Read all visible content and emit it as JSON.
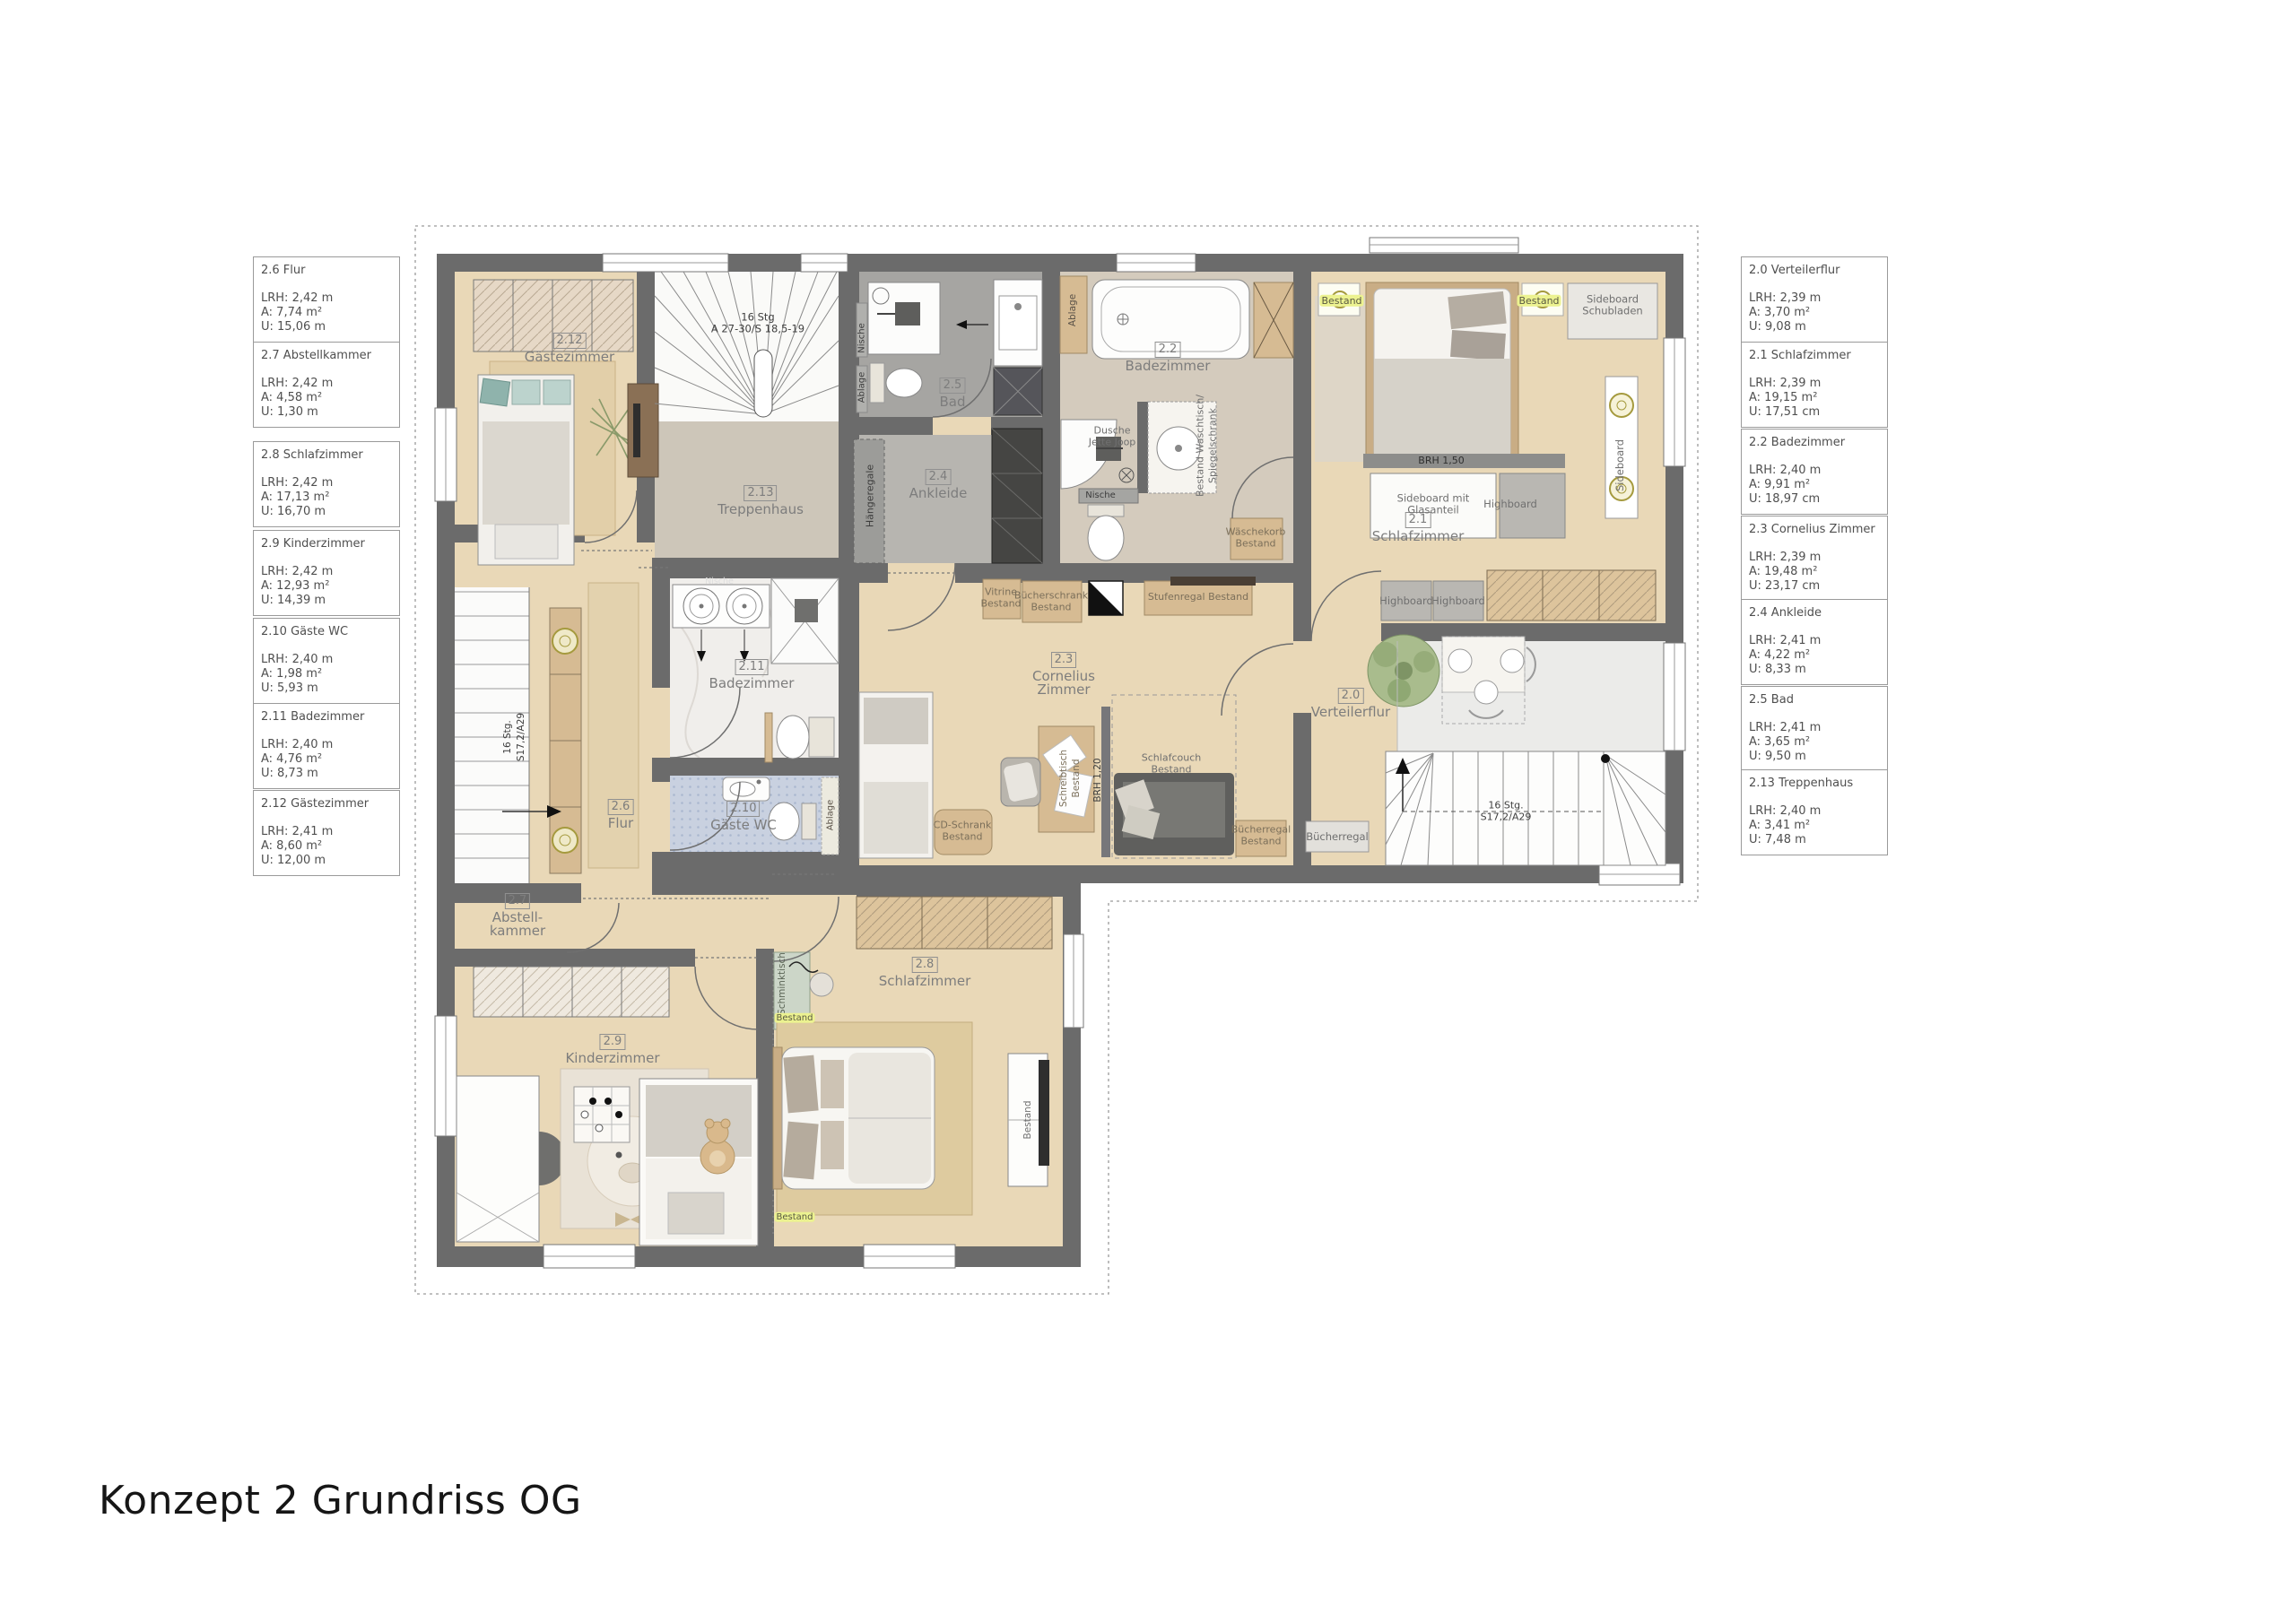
{
  "title": "Konzept 2 Grundriss OG",
  "colors": {
    "wall": "#6b6b6b",
    "wood_floor": "#e9d8b7",
    "greige_floor": "#d4cbbd",
    "stone_gray_floor": "#a6a5a2",
    "marble_floor": "#f0eeeb",
    "blue_tile_floor": "#c9d1e0",
    "furniture_wood": "#d6bb93",
    "highlight": "#ecf290",
    "label_gray": "#6f6f6f"
  },
  "legend_left": [
    {
      "title": "2.6 Flur",
      "lrh": "LRH: 2,42 m",
      "a": "A: 7,74 m²",
      "u": "U: 15,06 m"
    },
    {
      "title": "2.7 Abstellkammer",
      "lrh": "LRH: 2,42 m",
      "a": "A: 4,58 m²",
      "u": "U: 1,30 m"
    },
    {
      "title": "2.8 Schlafzimmer",
      "lrh": "LRH: 2,42 m",
      "a": "A: 17,13 m²",
      "u": "U: 16,70 m"
    },
    {
      "title": "2.9 Kinderzimmer",
      "lrh": "LRH: 2,42 m",
      "a": "A: 12,93 m²",
      "u": "U: 14,39 m"
    },
    {
      "title": "2.10 Gäste WC",
      "lrh": "LRH: 2,40 m",
      "a": "A: 1,98 m²",
      "u": "U: 5,93 m"
    },
    {
      "title": "2.11 Badezimmer",
      "lrh": "LRH: 2,40 m",
      "a": "A: 4,76 m²",
      "u": "U: 8,73 m"
    },
    {
      "title": "2.12 Gästezimmer",
      "lrh": "LRH: 2,41 m",
      "a": "A: 8,60 m²",
      "u": "U: 12,00 m"
    }
  ],
  "legend_right": [
    {
      "title": "2.0 Verteilerflur",
      "lrh": "LRH: 2,39 m",
      "a": "A: 3,70 m²",
      "u": "U: 9,08 m"
    },
    {
      "title": "2.1 Schlafzimmer",
      "lrh": "LRH: 2,39 m",
      "a": "A: 19,15 m²",
      "u": "U: 17,51 cm"
    },
    {
      "title": "2.2 Badezimmer",
      "lrh": "LRH: 2,40 m",
      "a": "A: 9,91 m²",
      "u": "U: 18,97 cm"
    },
    {
      "title": "2.3 Cornelius Zimmer",
      "lrh": "LRH: 2,39 m",
      "a": "A: 19,48 m²",
      "u": "U: 23,17 cm"
    },
    {
      "title": "2.4 Ankleide",
      "lrh": "LRH: 2,41 m",
      "a": "A: 4,22 m²",
      "u": "U: 8,33 m"
    },
    {
      "title": "2.5 Bad",
      "lrh": "LRH: 2,41 m",
      "a": "A: 3,65 m²",
      "u": "U: 9,50 m"
    },
    {
      "title": "2.13 Treppenhaus",
      "lrh": "LRH: 2,40 m",
      "a": "A: 3,41 m²",
      "u": "U: 7,48 m"
    }
  ],
  "plan": {
    "rooms": {
      "r212": {
        "num": "2.12",
        "name": "Gästezimmer"
      },
      "r213": {
        "num": "2.13",
        "name": "Treppenhaus"
      },
      "r25": {
        "num": "2.5",
        "name": "Bad"
      },
      "r24": {
        "num": "2.4",
        "name": "Ankleide"
      },
      "r22": {
        "num": "2.2",
        "name": "Badezimmer"
      },
      "r21": {
        "num": "2.1",
        "name": "Schlafzimmer"
      },
      "r23": {
        "num": "2.3",
        "name1": "Cornelius",
        "name2": "Zimmer"
      },
      "r20": {
        "num": "2.0",
        "name": "Verteilerflur"
      },
      "r26": {
        "num": "2.6",
        "name": "Flur"
      },
      "r211": {
        "num": "2.11",
        "name": "Badezimmer"
      },
      "r210": {
        "num": "2.10",
        "name": "Gäste WC"
      },
      "r27": {
        "num": "2.7",
        "name1": "Abstell-",
        "name2": "kammer"
      },
      "r29": {
        "num": "2.9",
        "name": "Kinderzimmer"
      },
      "r28": {
        "num": "2.8",
        "name": "Schlafzimmer"
      }
    },
    "stairs": {
      "top1": "16 Stg",
      "top2": "A 27-30/S 18,5-19",
      "main1": "16 Stg.",
      "main2": "S17,2/A29"
    },
    "annotations": {
      "nische": "Nische",
      "ablage": "Ablage",
      "haengeregale": "Hängeregale",
      "dusche1": "Dusche",
      "dusche2": "Jette Joop",
      "waschtisch1": "Bestand Waschtisch/",
      "waschtisch2": "Spiegelschrank",
      "waeschekorb1": "Wäschekorb",
      "waeschekorb2": "Bestand",
      "vitrine1": "Vitrine",
      "vitrine2": "Bestand",
      "buecherschrank1": "Bücherschrank",
      "buecherschrank2": "Bestand",
      "stufenregal": "Stufenregal Bestand",
      "bestand": "Bestand",
      "sideboard_schubladen1": "Sideboard",
      "sideboard_schubladen2": "Schubladen",
      "sideboard_glas1": "Sideboard mit",
      "sideboard_glas2": "Glasanteil",
      "highboard": "Highboard",
      "sideboard": "Sideboard",
      "brh150": "BRH 1,50",
      "brh120": "BRH 1,20",
      "buecherregal": "Bücherregal",
      "cdschrank1": "CD-Schrank",
      "cdschrank2": "Bestand",
      "schreibtisch1": "Schreibtisch",
      "schreibtisch2": "Bestand",
      "schlafcouch1": "Schlafcouch",
      "schlafcouch2": "Bestand",
      "schminktisch": "Schminktisch"
    }
  }
}
